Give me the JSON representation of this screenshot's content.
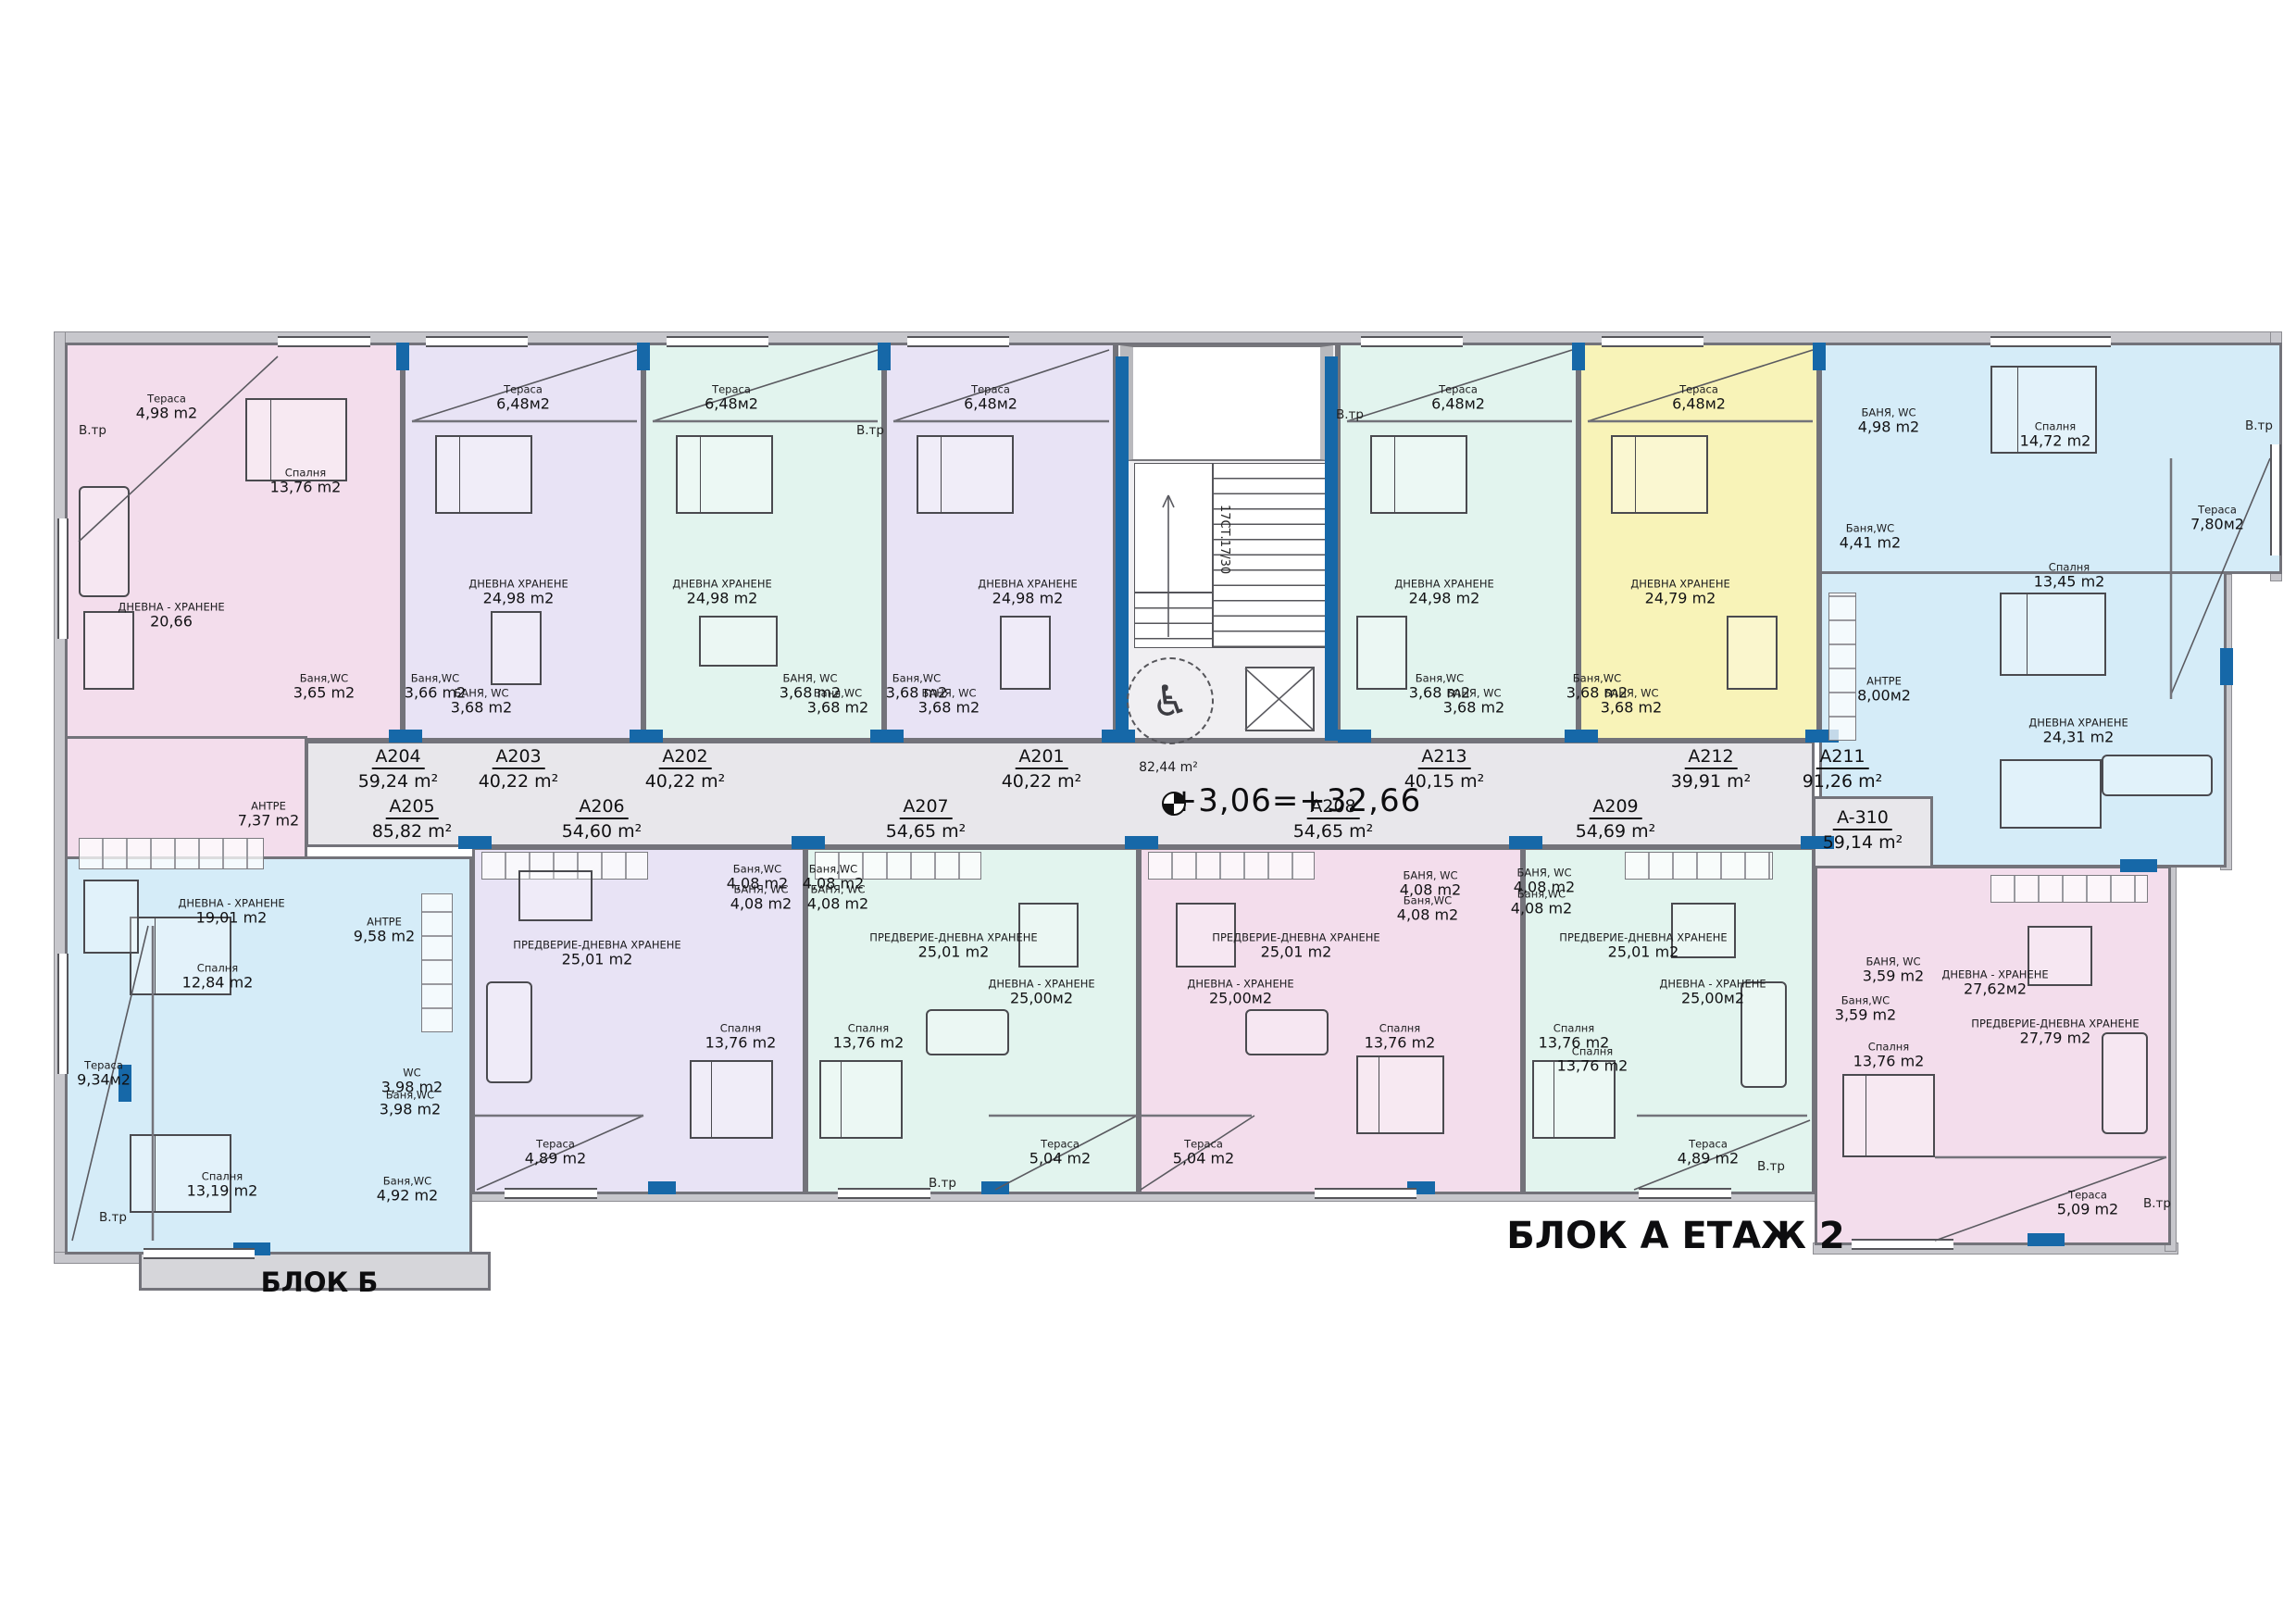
{
  "title": "БЛОК А ЕТАЖ 2",
  "block_b_label": "БЛОК Б",
  "level_mark": "+3,06=+32,66",
  "corridor": {
    "area": "82,44 m²",
    "stairs": "17СТ.17/30"
  },
  "annotations": {
    "vtr": "В.тр"
  },
  "colors": {
    "pink": "#f3ddec",
    "lavender": "#e8e3f5",
    "mint": "#e2f4ee",
    "cyan": "#d5ecf8",
    "yellow": "#f8f3b8",
    "corridor": "#e8e7eb",
    "accent": "#1668a8"
  },
  "apartments": [
    {
      "id": "A204",
      "area": "59,24 m²",
      "rooms": [
        {
          "name": "Тераса",
          "area": "4,98 m2"
        },
        {
          "name": "Спалня",
          "area": "13,76 m2"
        },
        {
          "name": "ДНЕВНА - ХРАНЕНЕ",
          "area": "20,66"
        },
        {
          "name": "Баня,WC",
          "area": "3,65 m2"
        },
        {
          "name": "АНТРЕ",
          "area": "7,37 m2"
        }
      ]
    },
    {
      "id": "A203",
      "area": "40,22 m²",
      "rooms": [
        {
          "name": "Тераса",
          "area": "6,48м2"
        },
        {
          "name": "ДНЕВНА ХРАНЕНЕ",
          "area": "24,98 m2"
        },
        {
          "name": "Баня,WC",
          "area": "3,66 m2"
        },
        {
          "name": "БАНЯ, WC",
          "area": "3,68 m2"
        }
      ]
    },
    {
      "id": "A202",
      "area": "40,22 m²",
      "rooms": [
        {
          "name": "Тераса",
          "area": "6,48м2"
        },
        {
          "name": "ДНЕВНА ХРАНЕНЕ",
          "area": "24,98 m2"
        },
        {
          "name": "БАНЯ, WC",
          "area": "3,68 m2"
        },
        {
          "name": "Баня,WC",
          "area": "3,68 m2"
        }
      ]
    },
    {
      "id": "A201",
      "area": "40,22 m²",
      "rooms": [
        {
          "name": "Тераса",
          "area": "6,48м2"
        },
        {
          "name": "ДНЕВНА ХРАНЕНЕ",
          "area": "24,98 m2"
        },
        {
          "name": "Баня,WC",
          "area": "3,68 m2"
        },
        {
          "name": "БАНЯ, WC",
          "area": "3,68 m2"
        }
      ]
    },
    {
      "id": "A213",
      "area": "40,15 m²",
      "rooms": [
        {
          "name": "Тераса",
          "area": "6,48м2"
        },
        {
          "name": "ДНЕВНА ХРАНЕНЕ",
          "area": "24,98 m2"
        },
        {
          "name": "Баня,WC",
          "area": "3,68 m2"
        },
        {
          "name": "БАНЯ, WC",
          "area": "3,68 m2"
        }
      ]
    },
    {
      "id": "A212",
      "area": "39,91 m²",
      "rooms": [
        {
          "name": "Тераса",
          "area": "6,48м2"
        },
        {
          "name": "ДНЕВНА ХРАНЕНЕ",
          "area": "24,79 m2"
        },
        {
          "name": "Баня,WC",
          "area": "3,68 m2"
        },
        {
          "name": "БАНЯ, WC",
          "area": "3,68 m2"
        }
      ]
    },
    {
      "id": "A211",
      "area": "91,26 m²",
      "rooms": [
        {
          "name": "БАНЯ, WC",
          "area": "4,98 m2"
        },
        {
          "name": "Спалня",
          "area": "14,72 m2"
        },
        {
          "name": "Тераса",
          "area": "7,80м2"
        },
        {
          "name": "Баня,WC",
          "area": "4,41 m2"
        },
        {
          "name": "Спалня",
          "area": "13,45 m2"
        },
        {
          "name": "АНТРЕ",
          "area": "8,00м2"
        },
        {
          "name": "ДНЕВНА ХРАНЕНЕ",
          "area": "24,31 m2"
        }
      ]
    },
    {
      "id": "A205",
      "area": "85,82 m²",
      "rooms": [
        {
          "name": "ДНЕВНА - ХРАНЕНЕ",
          "area": "19,01 m2"
        },
        {
          "name": "АНТРЕ",
          "area": "9,58 m2"
        },
        {
          "name": "Спалня",
          "area": "12,84 m2"
        },
        {
          "name": "Тераса",
          "area": "9,34м2"
        },
        {
          "name": "WC",
          "area": "3,98 m2"
        },
        {
          "name": "Баня,WC",
          "area": "3,98 m2"
        },
        {
          "name": "Спалня",
          "area": "13,19 m2"
        },
        {
          "name": "Баня,WC",
          "area": "4,92 m2"
        }
      ]
    },
    {
      "id": "A206",
      "area": "54,60 m²",
      "rooms": [
        {
          "name": "ПРЕДВЕРИЕ-ДНЕВНА ХРАНЕНЕ",
          "area": "25,01 m2"
        },
        {
          "name": "Баня,WC",
          "area": "4,08 m2"
        },
        {
          "name": "БАНЯ, WC",
          "area": "4,08 m2"
        },
        {
          "name": "Спалня",
          "area": "13,76 m2"
        },
        {
          "name": "Тераса",
          "area": "4,89 m2"
        }
      ]
    },
    {
      "id": "A207",
      "area": "54,65 m²",
      "rooms": [
        {
          "name": "Баня,WC",
          "area": "4,08 m2"
        },
        {
          "name": "БАНЯ, WC",
          "area": "4,08 m2"
        },
        {
          "name": "ПРЕДВЕРИЕ-ДНЕВНА ХРАНЕНЕ",
          "area": "25,01 m2"
        },
        {
          "name": "ДНЕВНА - ХРАНЕНЕ",
          "area": "25,00м2"
        },
        {
          "name": "Спалня",
          "area": "13,76 m2"
        },
        {
          "name": "Тераса",
          "area": "5,04 m2"
        }
      ]
    },
    {
      "id": "A208",
      "area": "54,65 m²",
      "rooms": [
        {
          "name": "БАНЯ, WC",
          "area": "4,08 m2"
        },
        {
          "name": "Баня,WC",
          "area": "4,08 m2"
        },
        {
          "name": "ПРЕДВЕРИЕ-ДНЕВНА ХРАНЕНЕ",
          "area": "25,01 m2"
        },
        {
          "name": "ДНЕВНА - ХРАНЕНЕ",
          "area": "25,00м2"
        },
        {
          "name": "Спалня",
          "area": "13,76 m2"
        },
        {
          "name": "Тераса",
          "area": "5,04 m2"
        }
      ]
    },
    {
      "id": "A209",
      "area": "54,69 m²",
      "rooms": [
        {
          "name": "БАНЯ, WC",
          "area": "4,08 m2"
        },
        {
          "name": "Баня,WC",
          "area": "4,08 m2"
        },
        {
          "name": "ПРЕДВЕРИЕ-ДНЕВНА ХРАНЕНЕ",
          "area": "25,01 m2"
        },
        {
          "name": "ДНЕВНА - ХРАНЕНЕ",
          "area": "25,00м2"
        },
        {
          "name": "Спалня",
          "area": "13,76 m2"
        },
        {
          "name": "Спалня",
          "area": "13,76 m2"
        },
        {
          "name": "Тераса",
          "area": "4,89 m2"
        }
      ]
    },
    {
      "id": "A-310",
      "area": "59,14 m²",
      "rooms": [
        {
          "name": "БАНЯ, WC",
          "area": "3,59 m2"
        },
        {
          "name": "Баня,WC",
          "area": "3,59 m2"
        },
        {
          "name": "ДНЕВНА - ХРАНЕНЕ",
          "area": "27,62м2"
        },
        {
          "name": "ПРЕДВЕРИЕ-ДНЕВНА ХРАНЕНЕ",
          "area": "27,79 m2"
        },
        {
          "name": "Спалня",
          "area": "13,76 m2"
        },
        {
          "name": "Тераса",
          "area": "5,09 m2"
        }
      ]
    }
  ]
}
